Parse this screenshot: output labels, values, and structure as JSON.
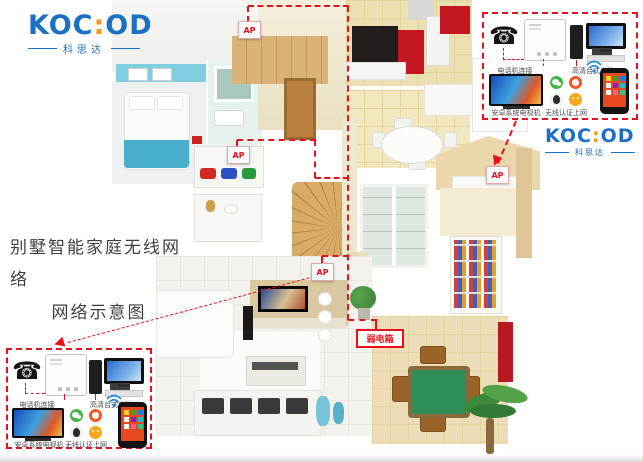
{
  "brand": {
    "name_left": "KOC",
    "separator": ":",
    "name_right": "OD",
    "sub": "科思达",
    "blue": "#1b6fc4",
    "orange": "#f7941d"
  },
  "title": {
    "line1": "别墅智能家庭无线网络",
    "line2": "网络示意图"
  },
  "network": {
    "ap_label": "AP",
    "weak_box_label": "弱电箱",
    "line_color": "#e8101c"
  },
  "callout": {
    "phone_label": "电话机连接",
    "pc_label": "高清台式电脑",
    "tv_label": "安卓系统电视机",
    "wifi_label": "无线认证上网",
    "icons": [
      {
        "name": "wechat-icon",
        "color": "#44b549"
      },
      {
        "name": "video-app-icon",
        "color": "#f05a28"
      },
      {
        "name": "qq-icon",
        "color": "#2b2b2b"
      },
      {
        "name": "wangwang-icon",
        "color": "#f7a71d"
      }
    ]
  }
}
